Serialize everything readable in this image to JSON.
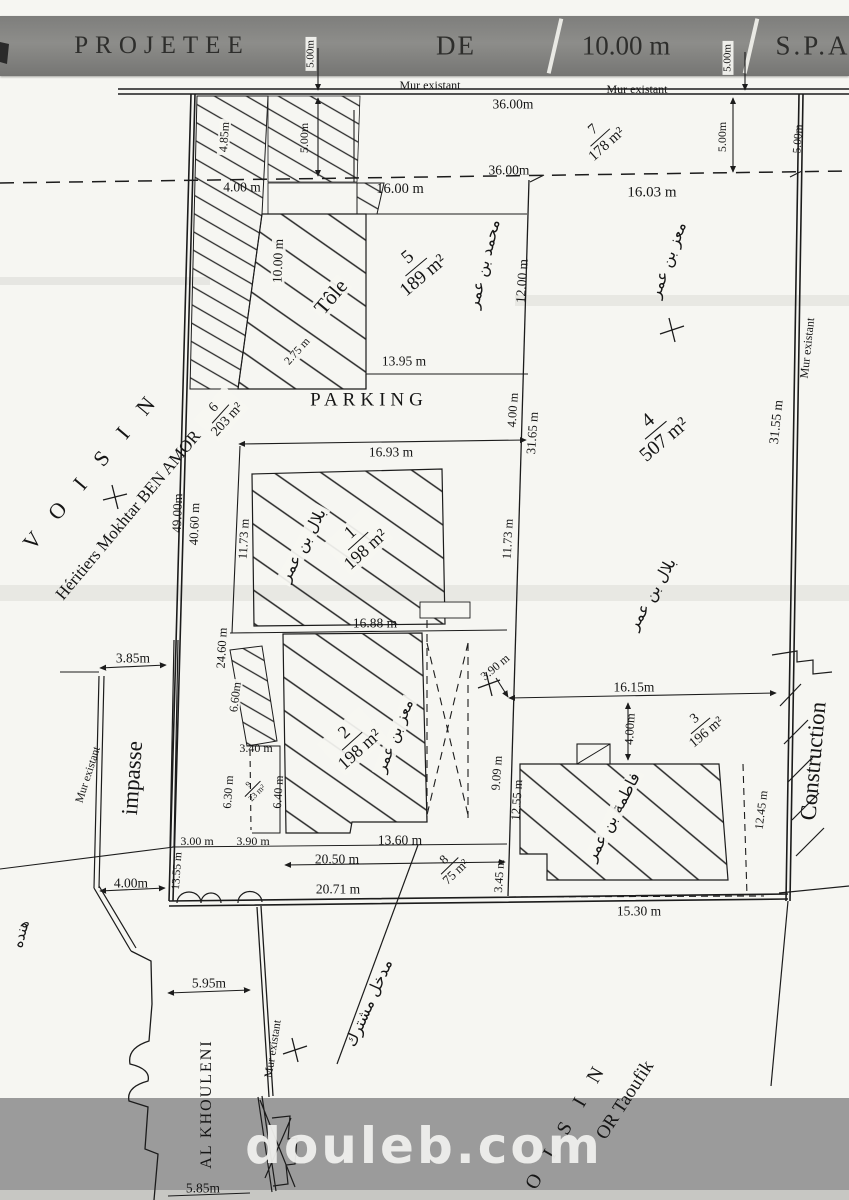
{
  "header": {
    "left": "PROJETEE",
    "de": "DE",
    "width": "10.00 m",
    "right": "S.P.A"
  },
  "walls": {
    "top1": "Mur existant",
    "top2": "Mur existant",
    "right": "Mur existant",
    "impasse": "Mur existant",
    "bottom": "Mur existant"
  },
  "neighbors": {
    "left_title": "V O I S I N",
    "left_name": "Héritiers Mokhtar BEN AMOR",
    "bottom_title": "V O I S I N",
    "bottom_name": "OR Taoufik",
    "street": "AL KHOULENI",
    "impasse": "impasse",
    "construction": "Construction",
    "arabic_fragment": "هنده"
  },
  "zones": {
    "parking": "PARKING",
    "tole": "Tôle",
    "shared_entrance": "مدخل مشترك"
  },
  "plots": {
    "p1": {
      "num": "1",
      "area": "198 m²",
      "owner": "بلال بن عمر"
    },
    "p2": {
      "num": "2",
      "area": "198 m²",
      "owner": "معز بن عمر"
    },
    "p3": {
      "num": "3",
      "area": "196 m²",
      "owner": "فاطمة بن عمر"
    },
    "p4": {
      "num": "4",
      "area": "507 m²",
      "owner_top": "معز بن عمر",
      "owner_bottom": "بلال بن عمر"
    },
    "p5": {
      "num": "5",
      "area": "189 m²",
      "owner": "محمد بن عمر"
    },
    "p6": {
      "num": "6",
      "area": "203 m²"
    },
    "p7": {
      "num": "7",
      "area": "178 m²"
    },
    "p8": {
      "num": "8",
      "area": "75 m²"
    },
    "p9": {
      "num": "9",
      "area": "23 m²"
    }
  },
  "dims": {
    "d36_top": "36.00m",
    "d36_mid": "36.00m",
    "d16_03": "16.03 m",
    "d5_band_left": "5.00m",
    "d5_band_right": "5.00m",
    "d5_left": "5.00m",
    "d5_mid": "5.00m",
    "d5_right": "5.00m",
    "d4_85": "4.85m",
    "d4_00_top": "4.00 m",
    "d16_00": "16.00 m",
    "d10_00": "10.00 m",
    "d2_75": "2.75 m",
    "d12_00": "12.00 m",
    "d13_95": "13.95 m",
    "d4_00_parking": "4.00 m",
    "d31_65": "31.65 m",
    "d31_55": "31.55 m",
    "d49_00": "49.00m",
    "d40_60": "40.60 m",
    "d16_93": "16.93 m",
    "d11_73_left": "11.73 m",
    "d11_73_right": "11.73 m",
    "d16_88": "16.88 m",
    "d24_60": "24.60 m",
    "d3_85": "3.85m",
    "d6_60": "6.60m",
    "d3_40": "3.40 m",
    "d6_30": "6.30 m",
    "d6_40": "6.40 m",
    "d3_90_diag": "3.90 m",
    "d9_09": "9.09 m",
    "d12_55": "12.55 m",
    "d3_00": "3.00 m",
    "d3_90": "3.90 m",
    "d13_60": "13.60 m",
    "d20_50": "20.50 m",
    "d3_45": "3.45 m",
    "d20_71": "20.71 m",
    "d13_55": "13.55 m",
    "d4_00_bottom": "4.00m",
    "d16_15": "16.15m",
    "d4_00_p3": "4.00m",
    "d12_45": "12.45 m",
    "d15_30": "15.30 m",
    "d5_95": "5.95m",
    "d5_85": "5.85m"
  },
  "watermark": {
    "text": "douleb.com"
  },
  "colors": {
    "ink": "#1c1c1c",
    "paper": "#f6f6f2",
    "band": "#9b9b9b",
    "watermark_text": "#f1f1ee"
  }
}
